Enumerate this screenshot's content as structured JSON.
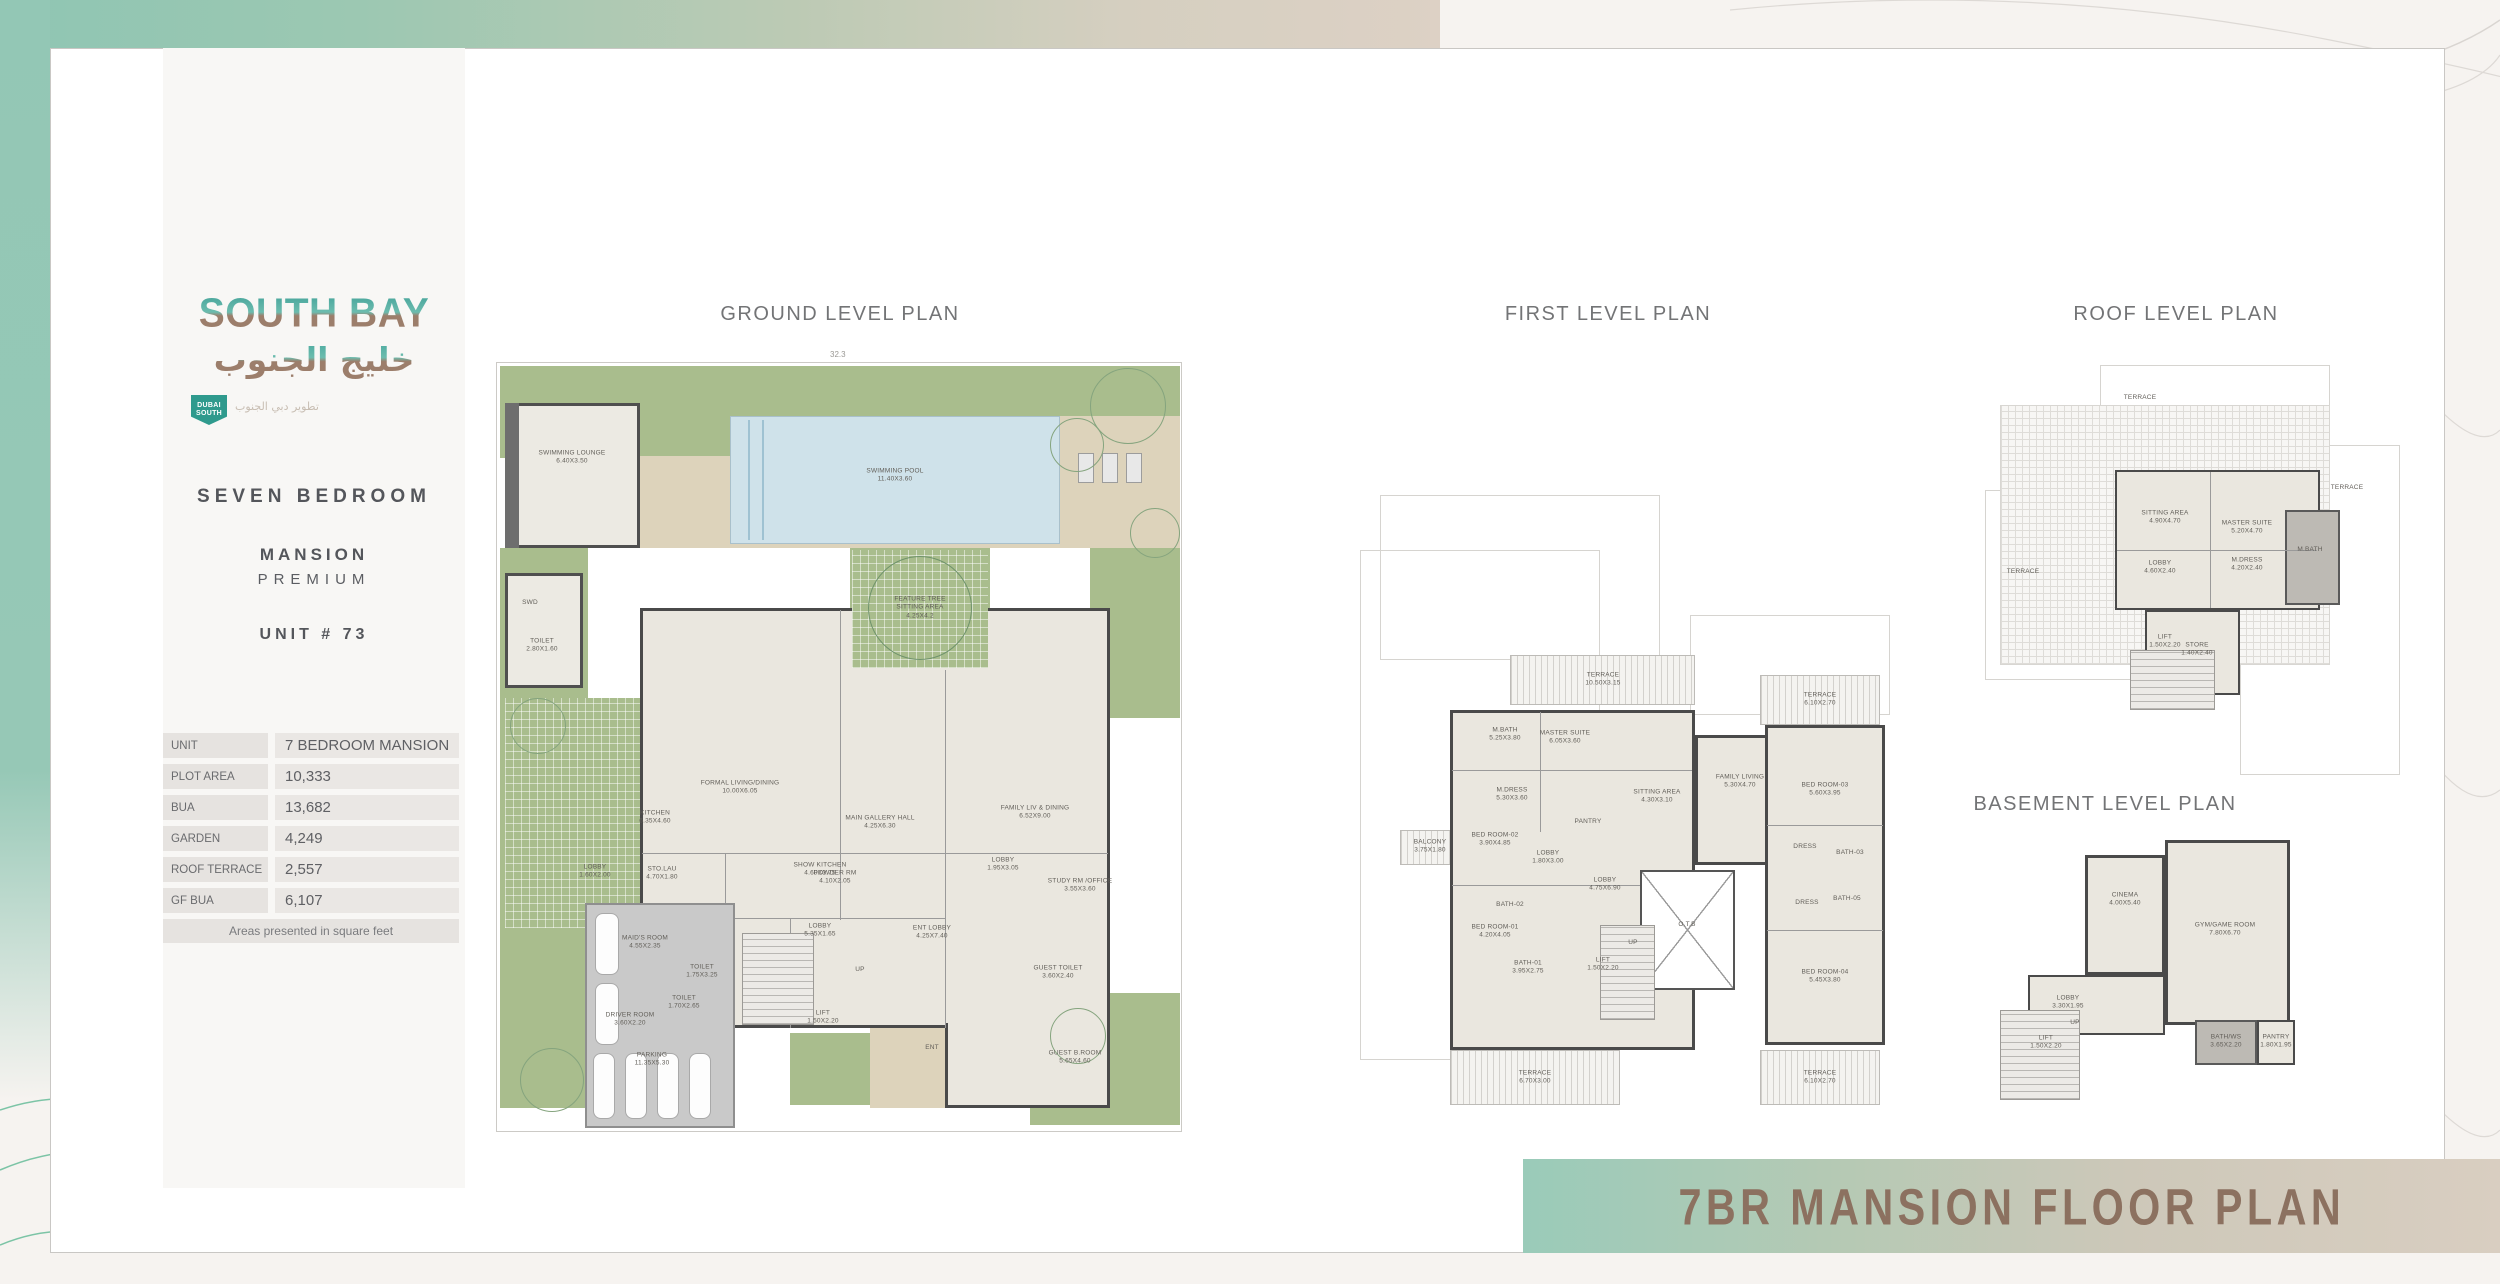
{
  "page": {
    "background_color": "#f6f3f0",
    "accent_teal": "#93c6b4",
    "accent_beige": "#ddd1c5",
    "banner": {
      "title": "7BR MANSION FLOOR PLAN",
      "text_color": "#8c7160"
    }
  },
  "sidebar": {
    "logo": {
      "title": "SOUTH BAY",
      "arabic": "خليج الجنوب",
      "badge_top": "DUBAI",
      "badge_bottom": "SOUTH",
      "tagline_arabic": "تطوير دبي الجنوب"
    },
    "unit_heading": "SEVEN BEDROOM",
    "unit_sub1": "MANSION",
    "unit_sub2": "PREMIUM",
    "unit_number": "UNIT # 73",
    "table": {
      "rows": [
        {
          "label": "UNIT",
          "value": "7 BEDROOM MANSION"
        },
        {
          "label": "PLOT AREA",
          "value": "10,333"
        },
        {
          "label": "BUA",
          "value": "13,682"
        },
        {
          "label": "GARDEN",
          "value": "4,249"
        },
        {
          "label": "ROOF TERRACE",
          "value": "2,557"
        },
        {
          "label": "GF BUA",
          "value": "6,107"
        }
      ],
      "footnote": "Areas presented in square feet"
    }
  },
  "plans": {
    "ground": {
      "title": "GROUND LEVEL PLAN",
      "top_dimension": "32.3",
      "labels": [
        {
          "t": "SWIMMING LOUNGE",
          "d": "6.40X3.50",
          "x": 82,
          "y": 100
        },
        {
          "t": "SWD",
          "d": "",
          "x": 40,
          "y": 245
        },
        {
          "t": "TOILET",
          "d": "2.80X1.60",
          "x": 52,
          "y": 288
        },
        {
          "t": "SWIMMING POOL",
          "d": "11.40X3.60",
          "x": 405,
          "y": 118
        },
        {
          "t": "FEATURE TREE",
          "d": "SITTING AREA\n4.25X4.2",
          "x": 430,
          "y": 250
        },
        {
          "t": "FORMAL LIVING/DINING",
          "d": "10.00X6.05",
          "x": 250,
          "y": 430
        },
        {
          "t": "MAIN GALLERY HALL",
          "d": "4.25X6.30",
          "x": 390,
          "y": 465
        },
        {
          "t": "FAMILY LIV & DINING",
          "d": "6.52X9.00",
          "x": 545,
          "y": 455
        },
        {
          "t": "SHOW KITCHEN",
          "d": "4.60X3.75",
          "x": 330,
          "y": 512
        },
        {
          "t": "KITCHEN",
          "d": "6.35X4.60",
          "x": 165,
          "y": 460
        },
        {
          "t": "LOBBY",
          "d": "1.60X2.00",
          "x": 105,
          "y": 514
        },
        {
          "t": "STO.LAU",
          "d": "4.70X1.80",
          "x": 172,
          "y": 516
        },
        {
          "t": "MAID'S ROOM",
          "d": "4.55X2.35",
          "x": 155,
          "y": 585
        },
        {
          "t": "TOILET",
          "d": "1.75X3.25",
          "x": 212,
          "y": 614
        },
        {
          "t": "DRIVER ROOM",
          "d": "3.60X2.20",
          "x": 140,
          "y": 662
        },
        {
          "t": "TOILET",
          "d": "1.70X2.65",
          "x": 194,
          "y": 645
        },
        {
          "t": "POWDER RM",
          "d": "4.10X2.05",
          "x": 345,
          "y": 520
        },
        {
          "t": "LOBBY",
          "d": "5.35X1.65",
          "x": 330,
          "y": 573
        },
        {
          "t": "LIFT",
          "d": "1.50X2.20",
          "x": 333,
          "y": 660
        },
        {
          "t": "UP",
          "d": "",
          "x": 370,
          "y": 612
        },
        {
          "t": "ENT LOBBY",
          "d": "4.25X7.40",
          "x": 442,
          "y": 575
        },
        {
          "t": "LOBBY",
          "d": "1.95X3.05",
          "x": 513,
          "y": 507
        },
        {
          "t": "STUDY RM /OFFICE",
          "d": "3.55X3.60",
          "x": 590,
          "y": 528
        },
        {
          "t": "GUEST TOILET",
          "d": "3.60X2.40",
          "x": 568,
          "y": 615
        },
        {
          "t": "GUEST B.ROOM",
          "d": "5.65X4.60",
          "x": 585,
          "y": 700
        },
        {
          "t": "PARKING",
          "d": "11.35X5.30",
          "x": 162,
          "y": 702
        },
        {
          "t": "ENT",
          "d": "",
          "x": 442,
          "y": 690
        }
      ]
    },
    "first": {
      "title": "FIRST LEVEL PLAN",
      "labels": [
        {
          "t": "TERRACE",
          "d": "10.50X3.15",
          "x": 243,
          "y": 185
        },
        {
          "t": "M.BATH",
          "d": "5.25X3.80",
          "x": 145,
          "y": 240
        },
        {
          "t": "MASTER SUITE",
          "d": "6.05X3.60",
          "x": 205,
          "y": 243
        },
        {
          "t": "M.DRESS",
          "d": "5.30X3.60",
          "x": 152,
          "y": 300
        },
        {
          "t": "SITTING AREA",
          "d": "4.30X3.10",
          "x": 297,
          "y": 302
        },
        {
          "t": "FAMILY LIVING",
          "d": "5.30X4.70",
          "x": 380,
          "y": 287
        },
        {
          "t": "TERRACE",
          "d": "6.10X2.70",
          "x": 460,
          "y": 205
        },
        {
          "t": "BED ROOM-03",
          "d": "5.60X3.95",
          "x": 465,
          "y": 295
        },
        {
          "t": "BALCONY",
          "d": "3.75X1.80",
          "x": 70,
          "y": 352
        },
        {
          "t": "BED ROOM-02",
          "d": "3.90X4.85",
          "x": 135,
          "y": 345
        },
        {
          "t": "PANTRY",
          "d": "",
          "x": 228,
          "y": 327
        },
        {
          "t": "LOBBY",
          "d": "1.80X3.00",
          "x": 188,
          "y": 363
        },
        {
          "t": "BATH-02",
          "d": "",
          "x": 150,
          "y": 410
        },
        {
          "t": "LOBBY",
          "d": "4.75X6.90",
          "x": 245,
          "y": 390
        },
        {
          "t": "BED ROOM-01",
          "d": "4.20X4.05",
          "x": 135,
          "y": 437
        },
        {
          "t": "BATH-01",
          "d": "3.95X2.75",
          "x": 168,
          "y": 473
        },
        {
          "t": "LIFT",
          "d": "1.50X2.20",
          "x": 243,
          "y": 470
        },
        {
          "t": "UP",
          "d": "",
          "x": 273,
          "y": 448
        },
        {
          "t": "O.T.B",
          "d": "",
          "x": 327,
          "y": 430
        },
        {
          "t": "TERRACE",
          "d": "6.70X3.00",
          "x": 175,
          "y": 583
        },
        {
          "t": "DRESS",
          "d": "",
          "x": 445,
          "y": 352
        },
        {
          "t": "BATH-03",
          "d": "",
          "x": 490,
          "y": 358
        },
        {
          "t": "DRESS",
          "d": "",
          "x": 447,
          "y": 408
        },
        {
          "t": "BATH-05",
          "d": "",
          "x": 487,
          "y": 404
        },
        {
          "t": "BED ROOM-04",
          "d": "5.45X3.80",
          "x": 465,
          "y": 482
        },
        {
          "t": "TERRACE",
          "d": "6.10X2.70",
          "x": 460,
          "y": 583
        }
      ]
    },
    "roof": {
      "title": "ROOF LEVEL PLAN",
      "labels": [
        {
          "t": "TERRACE",
          "d": "",
          "x": 155,
          "y": 48
        },
        {
          "t": "TERRACE",
          "d": "",
          "x": 362,
          "y": 138
        },
        {
          "t": "TERRACE",
          "d": "",
          "x": 38,
          "y": 222
        },
        {
          "t": "SITTING AREA",
          "d": "4.90X4.70",
          "x": 180,
          "y": 168
        },
        {
          "t": "MASTER SUITE",
          "d": "5.20X4.70",
          "x": 262,
          "y": 178
        },
        {
          "t": "M.BATH",
          "d": "",
          "x": 325,
          "y": 200
        },
        {
          "t": "LOBBY",
          "d": "4.60X2.40",
          "x": 175,
          "y": 218
        },
        {
          "t": "M.DRESS",
          "d": "4.20X2.40",
          "x": 262,
          "y": 215
        },
        {
          "t": "LIFT",
          "d": "1.50X2.20",
          "x": 180,
          "y": 292
        },
        {
          "t": "STORE",
          "d": "1.40X2.40",
          "x": 212,
          "y": 300
        }
      ]
    },
    "basement": {
      "title": "BASEMENT LEVEL PLAN",
      "labels": [
        {
          "t": "CINEMA",
          "d": "4.00X5.40",
          "x": 125,
          "y": 65
        },
        {
          "t": "GYM/GAME ROOM",
          "d": "7.80X6.70",
          "x": 225,
          "y": 95
        },
        {
          "t": "LOBBY",
          "d": "3.30X1.95",
          "x": 68,
          "y": 168
        },
        {
          "t": "UP",
          "d": "",
          "x": 75,
          "y": 188
        },
        {
          "t": "LIFT",
          "d": "1.50X2.20",
          "x": 46,
          "y": 208
        },
        {
          "t": "BATH/WS",
          "d": "3.65X2.20",
          "x": 226,
          "y": 207
        },
        {
          "t": "PANTRY",
          "d": "1.80X1.95",
          "x": 276,
          "y": 207
        }
      ]
    }
  }
}
